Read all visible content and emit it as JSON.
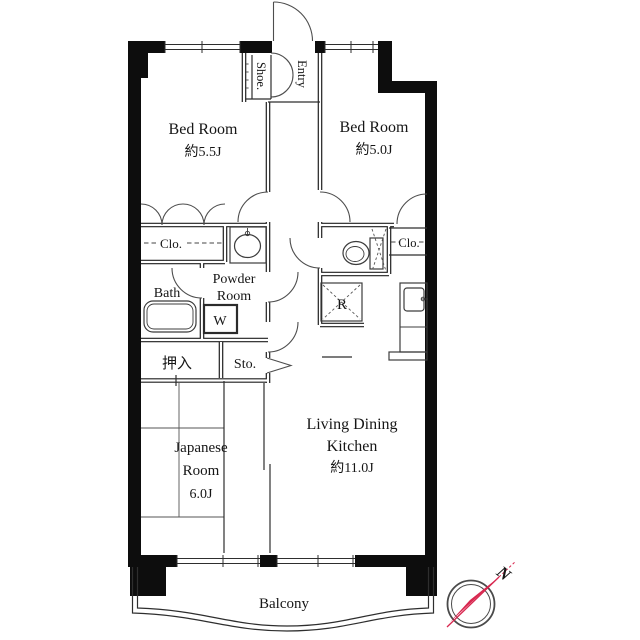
{
  "plan": {
    "rooms": {
      "bedroom_a": {
        "label": "Bed Room",
        "area": "約5.5J"
      },
      "bedroom_b": {
        "label": "Bed Room",
        "area": "約5.0J"
      },
      "living": {
        "label_line1": "Living Dining",
        "label_line2": "Kitchen",
        "area": "約11.0J"
      },
      "japanese": {
        "label_line1": "Japanese",
        "label_line2": "Room",
        "area": "6.0J"
      },
      "bath": {
        "label": "Bath"
      },
      "powder": {
        "label_line1": "Powder",
        "label_line2": "Room"
      },
      "washer": {
        "label": "W"
      },
      "oshiire": {
        "label": "押入"
      },
      "storage": {
        "label": "Sto."
      },
      "closet_left": {
        "label": "Clo."
      },
      "closet_right": {
        "label": "Clo."
      },
      "refrigerator": {
        "label": "R"
      },
      "entry": {
        "label": "Entry"
      },
      "shoe": {
        "label": "Shoe."
      },
      "balcony": {
        "label": "Balcony"
      }
    },
    "compass": {
      "label": "N",
      "needle_color": "#d8274f",
      "ring_color": "#4a4a4a"
    },
    "colors": {
      "outer_wall": "#0d0d0d",
      "partition": "#1f1f1f",
      "text": "#161616"
    }
  }
}
